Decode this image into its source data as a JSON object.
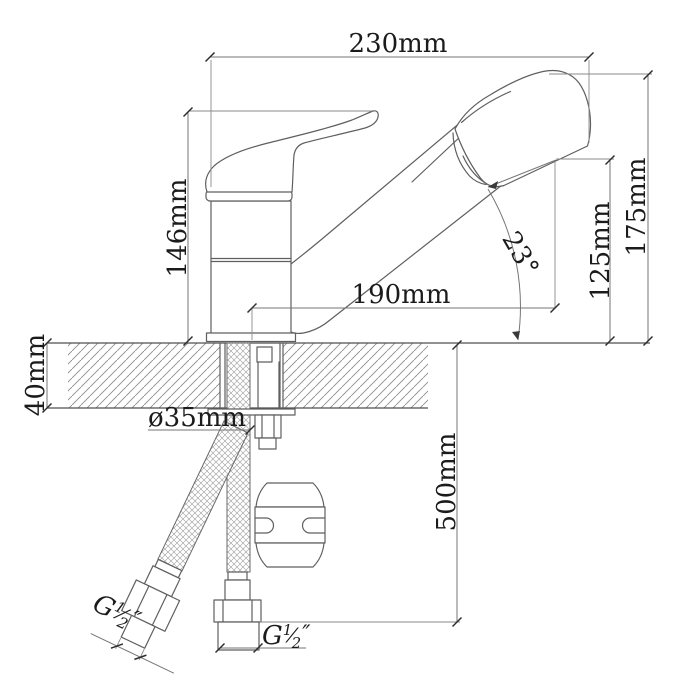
{
  "drawing": {
    "dim_230": "230mm",
    "dim_146": "146mm",
    "dim_175": "175mm",
    "dim_125": "125mm",
    "dim_190": "190mm",
    "angle_23": "23°",
    "dim_40": "40mm",
    "dim_hole": "ø35mm",
    "dim_500": "500mm",
    "thread_left": {
      "prefix": "G",
      "numerator": "1",
      "slash": "⁄",
      "denominator": "2",
      "suffix": "″"
    },
    "thread_bottom": {
      "prefix": "G",
      "numerator": "1",
      "slash": "⁄",
      "denominator": "2",
      "suffix": "″"
    },
    "colors": {
      "outline": "#5f5f5f",
      "dimension": "#767676",
      "text": "#1b1b1b",
      "background": "#ffffff"
    }
  }
}
